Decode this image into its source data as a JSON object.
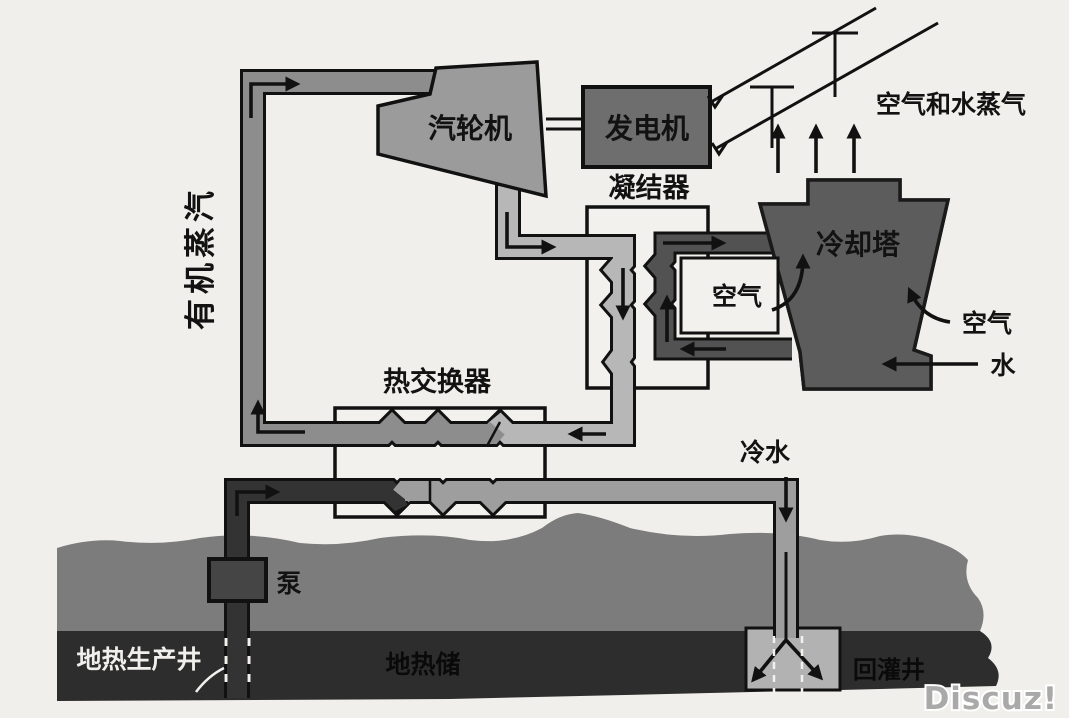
{
  "diagram": {
    "title_hint": "binary-cycle geothermal power plant schematic",
    "labels": {
      "organic_vapor": "有机蒸汽",
      "turbine": "汽轮机",
      "generator": "发电机",
      "condenser": "凝结器",
      "cooling_tower": "冷却塔",
      "air_and_steam": "空气和水蒸气",
      "air_left": "空气",
      "air_right": "空气",
      "water": "水",
      "heat_exchanger": "热交换器",
      "cold_water": "冷水",
      "pump": "泵",
      "production_well": "地热生产井",
      "reservoir": "地热储",
      "injection_well": "回灌井"
    },
    "watermark": "Discuz!",
    "palette": {
      "background": "#f1efeb",
      "organic_vapor_pipe": "#8d8d8d",
      "condensate_pipe": "#b7b7b7",
      "hot_brine_pipe": "#333333",
      "cold_water_pipe": "#9e9e9e",
      "cooling_water_pipe": "#525252",
      "cooling_tower": "#5c5c5c",
      "turbine": "#9b9b9b",
      "generator": "#6e6e6e",
      "pump": "#454545",
      "ground": "#7c7c7c",
      "reservoir": "#2d2d2d",
      "injection_zone": "#b2b2b2",
      "outline": "#111111",
      "watermark_fill": "#a9a9a9"
    }
  }
}
